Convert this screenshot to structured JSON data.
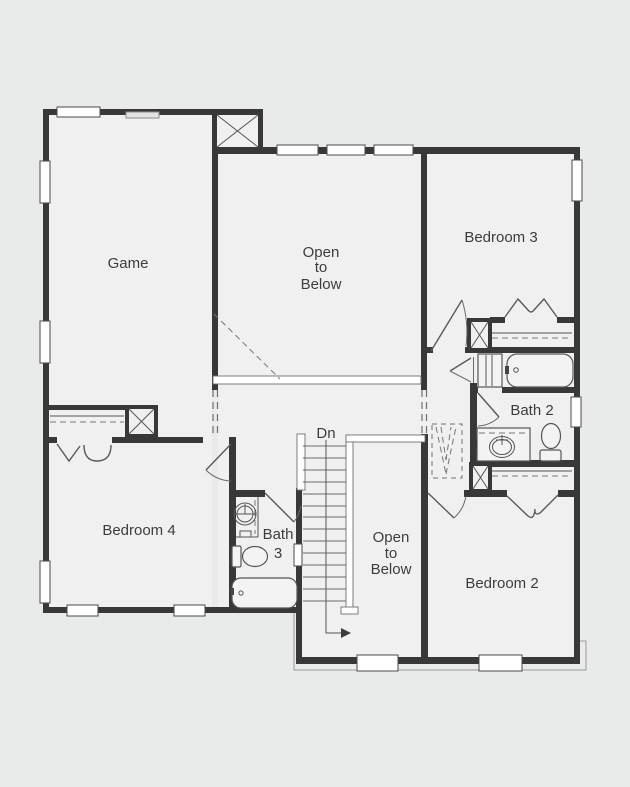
{
  "plan": {
    "type": "architectural-floor-plan",
    "labels": {
      "game": "Game",
      "open_upper": [
        "Open",
        "to",
        "Below"
      ],
      "bedroom3": "Bedroom 3",
      "bath2": "Bath 2",
      "bedroom4": "Bedroom 4",
      "bath3": [
        "Bath",
        "3"
      ],
      "dn": "Dn",
      "open_lower": [
        "Open",
        "to",
        "Below"
      ],
      "bedroom2": "Bedroom 2"
    },
    "colors": {
      "background": "#e9eaea",
      "floor": "#f0f0f0",
      "wall": "#383838",
      "window_fill": "#ffffff",
      "line": "#555555",
      "dashed_line": "#777777",
      "text": "#3d3d3d"
    },
    "icons": [
      "bathtub-icon",
      "toilet-icon",
      "sink-icon",
      "vanity-sink-icon",
      "bifold-door-icon",
      "door-swing-icon",
      "stair-treads-icon",
      "column-x-icon",
      "railing-hatch-icon",
      "attic-access-icon",
      "window-icon"
    ]
  }
}
